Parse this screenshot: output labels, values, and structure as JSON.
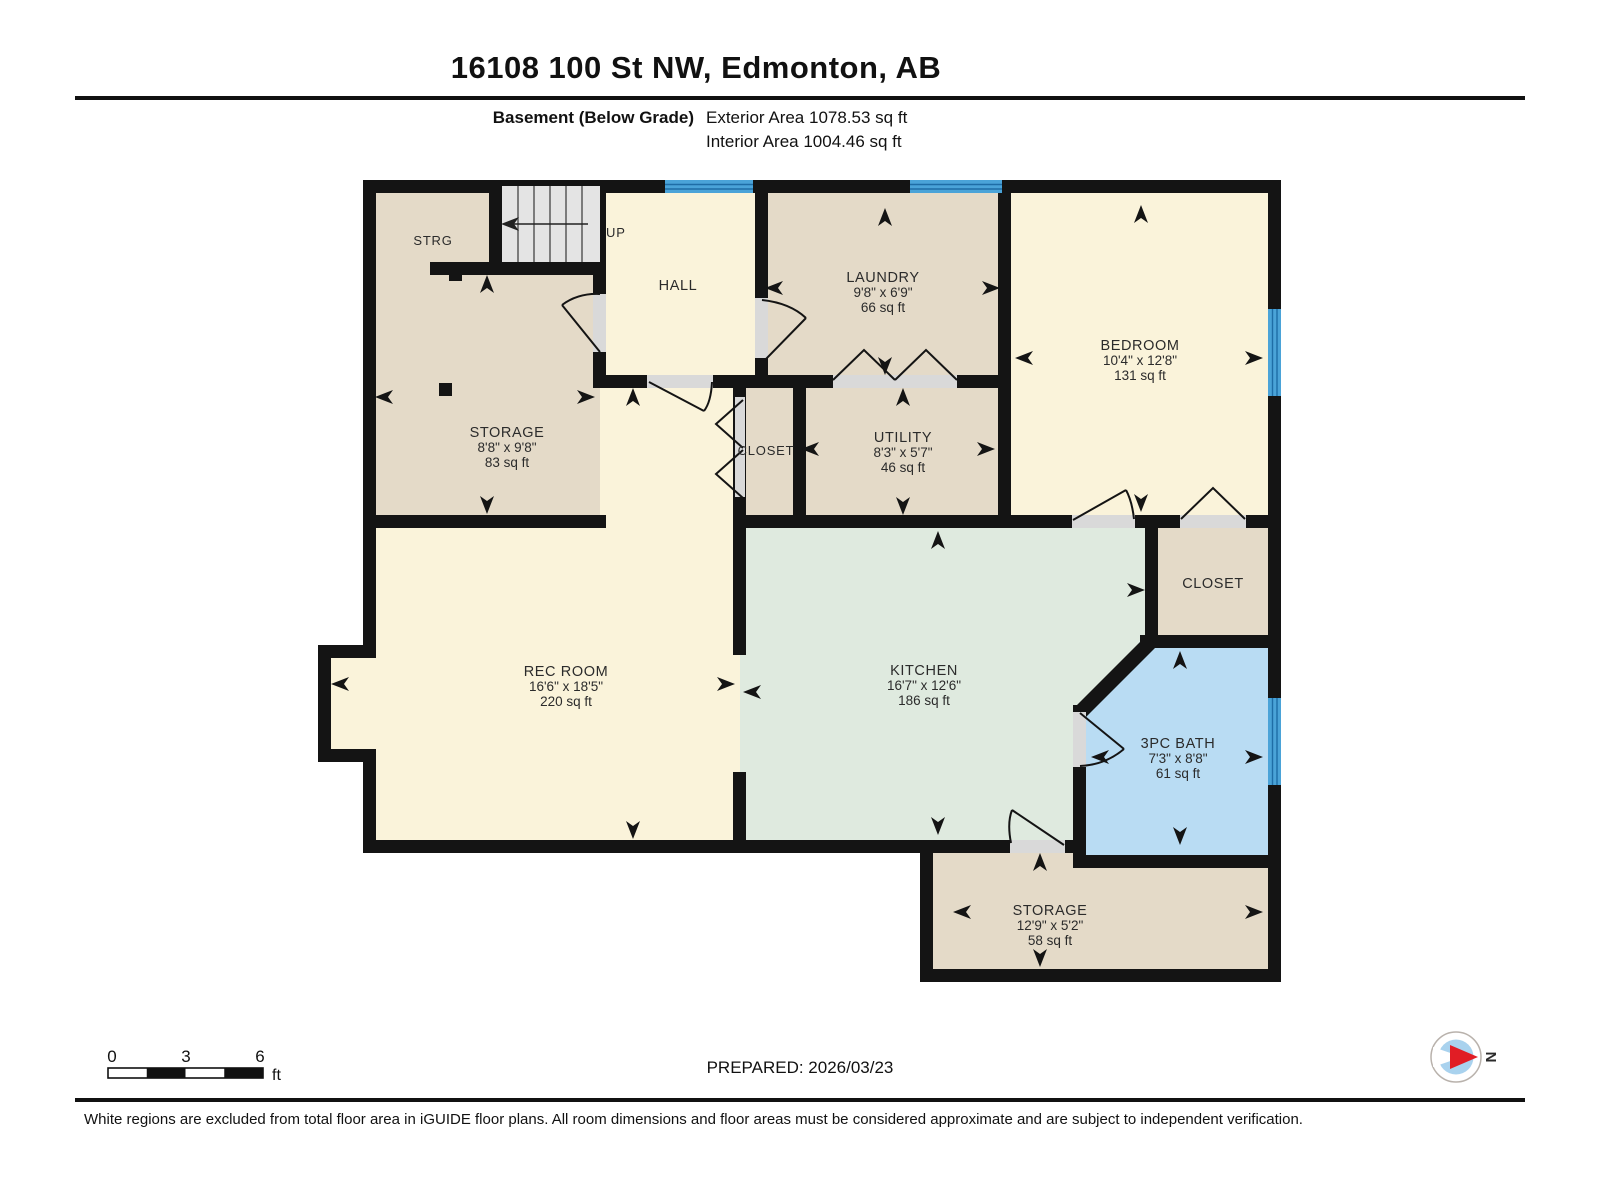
{
  "header": {
    "title": "16108 100 St NW, Edmonton, AB",
    "floor_label": "Basement (Below Grade)",
    "exterior_area": "Exterior Area 1078.53 sq ft",
    "interior_area": "Interior Area 1004.46 sq ft"
  },
  "rooms": {
    "strg": {
      "name": "STRG"
    },
    "stairs": {
      "label": "UP"
    },
    "hall": {
      "name": "HALL"
    },
    "storage_nw": {
      "name": "STORAGE",
      "dims": "8'8\" x 9'8\"",
      "area": "83 sq ft"
    },
    "laundry": {
      "name": "LAUNDRY",
      "dims": "9'8\" x 6'9\"",
      "area": "66 sq ft"
    },
    "bedroom": {
      "name": "BEDROOM",
      "dims": "10'4\" x 12'8\"",
      "area": "131 sq ft"
    },
    "closet_mid": {
      "name": "CLOSET"
    },
    "utility": {
      "name": "UTILITY",
      "dims": "8'3\" x 5'7\"",
      "area": "46 sq ft"
    },
    "closet_right": {
      "name": "CLOSET"
    },
    "rec_room": {
      "name": "REC ROOM",
      "dims": "16'6\" x 18'5\"",
      "area": "220 sq ft"
    },
    "kitchen": {
      "name": "KITCHEN",
      "dims": "16'7\" x 12'6\"",
      "area": "186 sq ft"
    },
    "bath": {
      "name": "3PC BATH",
      "dims": "7'3\" x 8'8\"",
      "area": "61 sq ft"
    },
    "storage_s": {
      "name": "STORAGE",
      "dims": "12'9\" x 5'2\"",
      "area": "58 sq ft"
    }
  },
  "scale_bar": {
    "tick_0": "0",
    "tick_3": "3",
    "tick_6": "6",
    "unit": "ft"
  },
  "footer": {
    "prepared": "PREPARED: 2026/03/23",
    "disclaimer": "White regions are excluded from total floor area in iGUIDE floor plans. All room dimensions and floor areas must be considered approximate and are subject to independent verification.",
    "compass_north": "N"
  },
  "colors": {
    "wall": "#141414",
    "room_cream": "#faf3da",
    "room_tan": "#e4dac8",
    "room_green": "#dfeadf",
    "room_blue": "#b9dcf3",
    "window_blue": "#4aa3d8",
    "compass_red": "#e11d25"
  }
}
